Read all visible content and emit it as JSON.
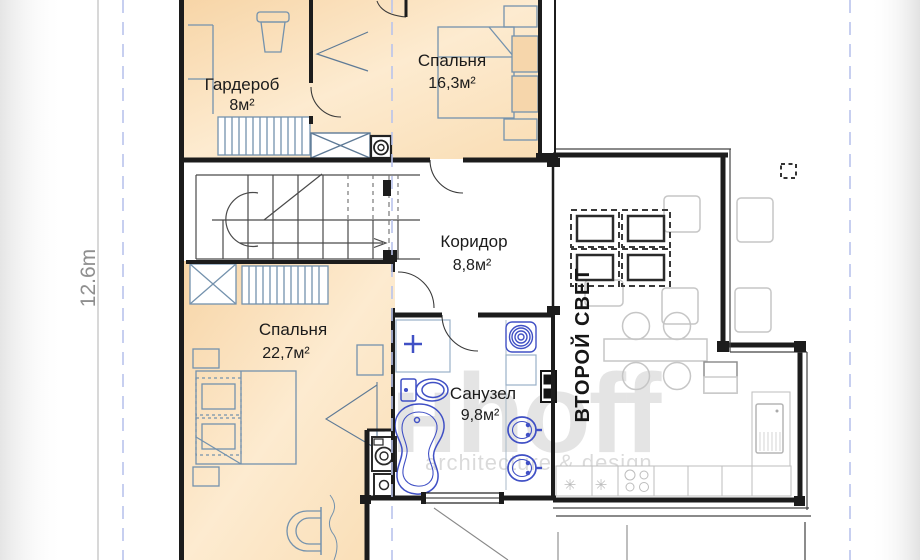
{
  "dimension": {
    "height_label": "12.6m"
  },
  "rooms": {
    "wardrobe": {
      "name": "Гардероб",
      "area": "8м²"
    },
    "bedroom_small": {
      "name": "Спальня",
      "area": "16,3м²"
    },
    "corridor": {
      "name": "Коридор",
      "area": "8,8м²"
    },
    "bedroom_large": {
      "name": "Спальня",
      "area": "22,7м²"
    },
    "bathroom": {
      "name": "Санузел",
      "area": "9,8м²"
    },
    "double_height": {
      "name": "ВТОРОЙ СВЕТ"
    }
  },
  "watermark": {
    "main": "анhoff",
    "sub": "architecture & design"
  },
  "colors": {
    "room_fill": "#fbe2bf",
    "wall": "#1c1c1c",
    "fixture_blue": "#4050c5",
    "furniture": "#7492ad",
    "ridge_dash": "#b9c3ec"
  }
}
